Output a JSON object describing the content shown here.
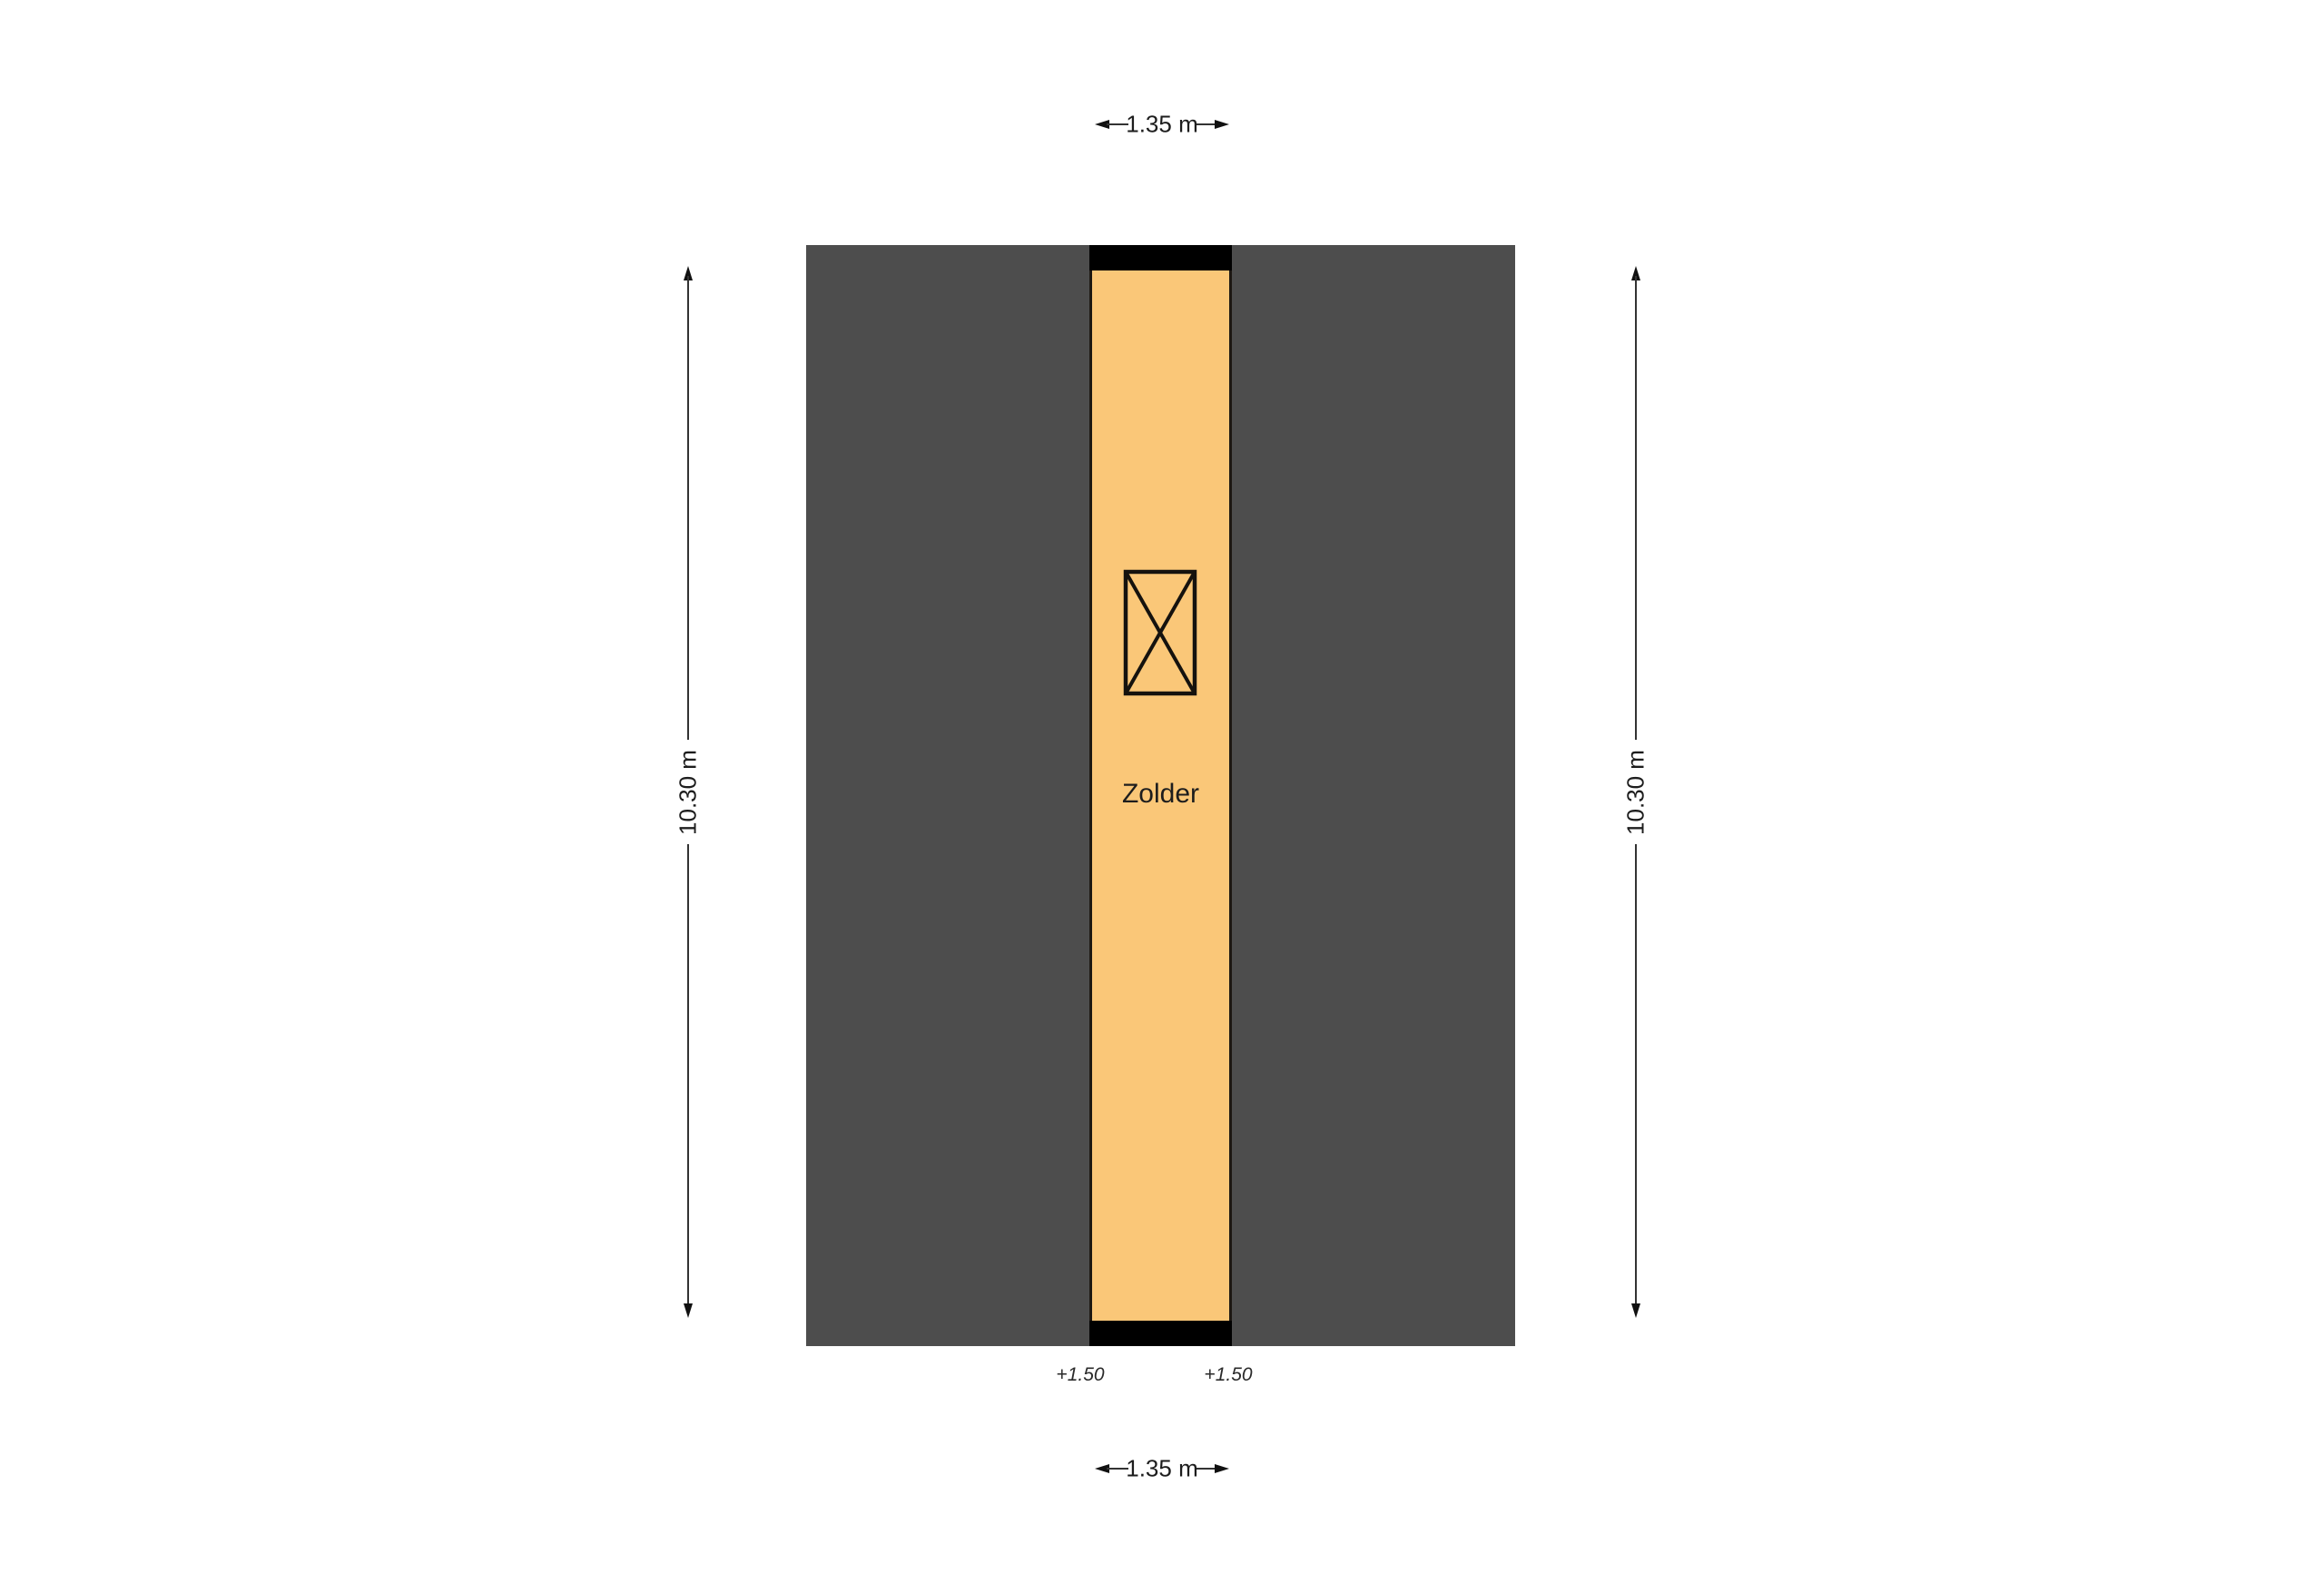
{
  "colors": {
    "background": "#FFFFFF",
    "roof_area": "#4D4D4D",
    "room_fill": "#FAC778",
    "wall": "#000000",
    "dimension_line": "#333333",
    "text": "#1D1D1D"
  },
  "plan": {
    "room_label": "Zolder",
    "crossed_symbol": "crossed-rectangle",
    "level_markers": {
      "left": "+1.50",
      "right": "+1.50"
    },
    "dimensions": {
      "width_top": "1.35 m",
      "width_bottom": "1.35 m",
      "height_left": "10.30 m",
      "height_right": "10.30 m"
    }
  }
}
